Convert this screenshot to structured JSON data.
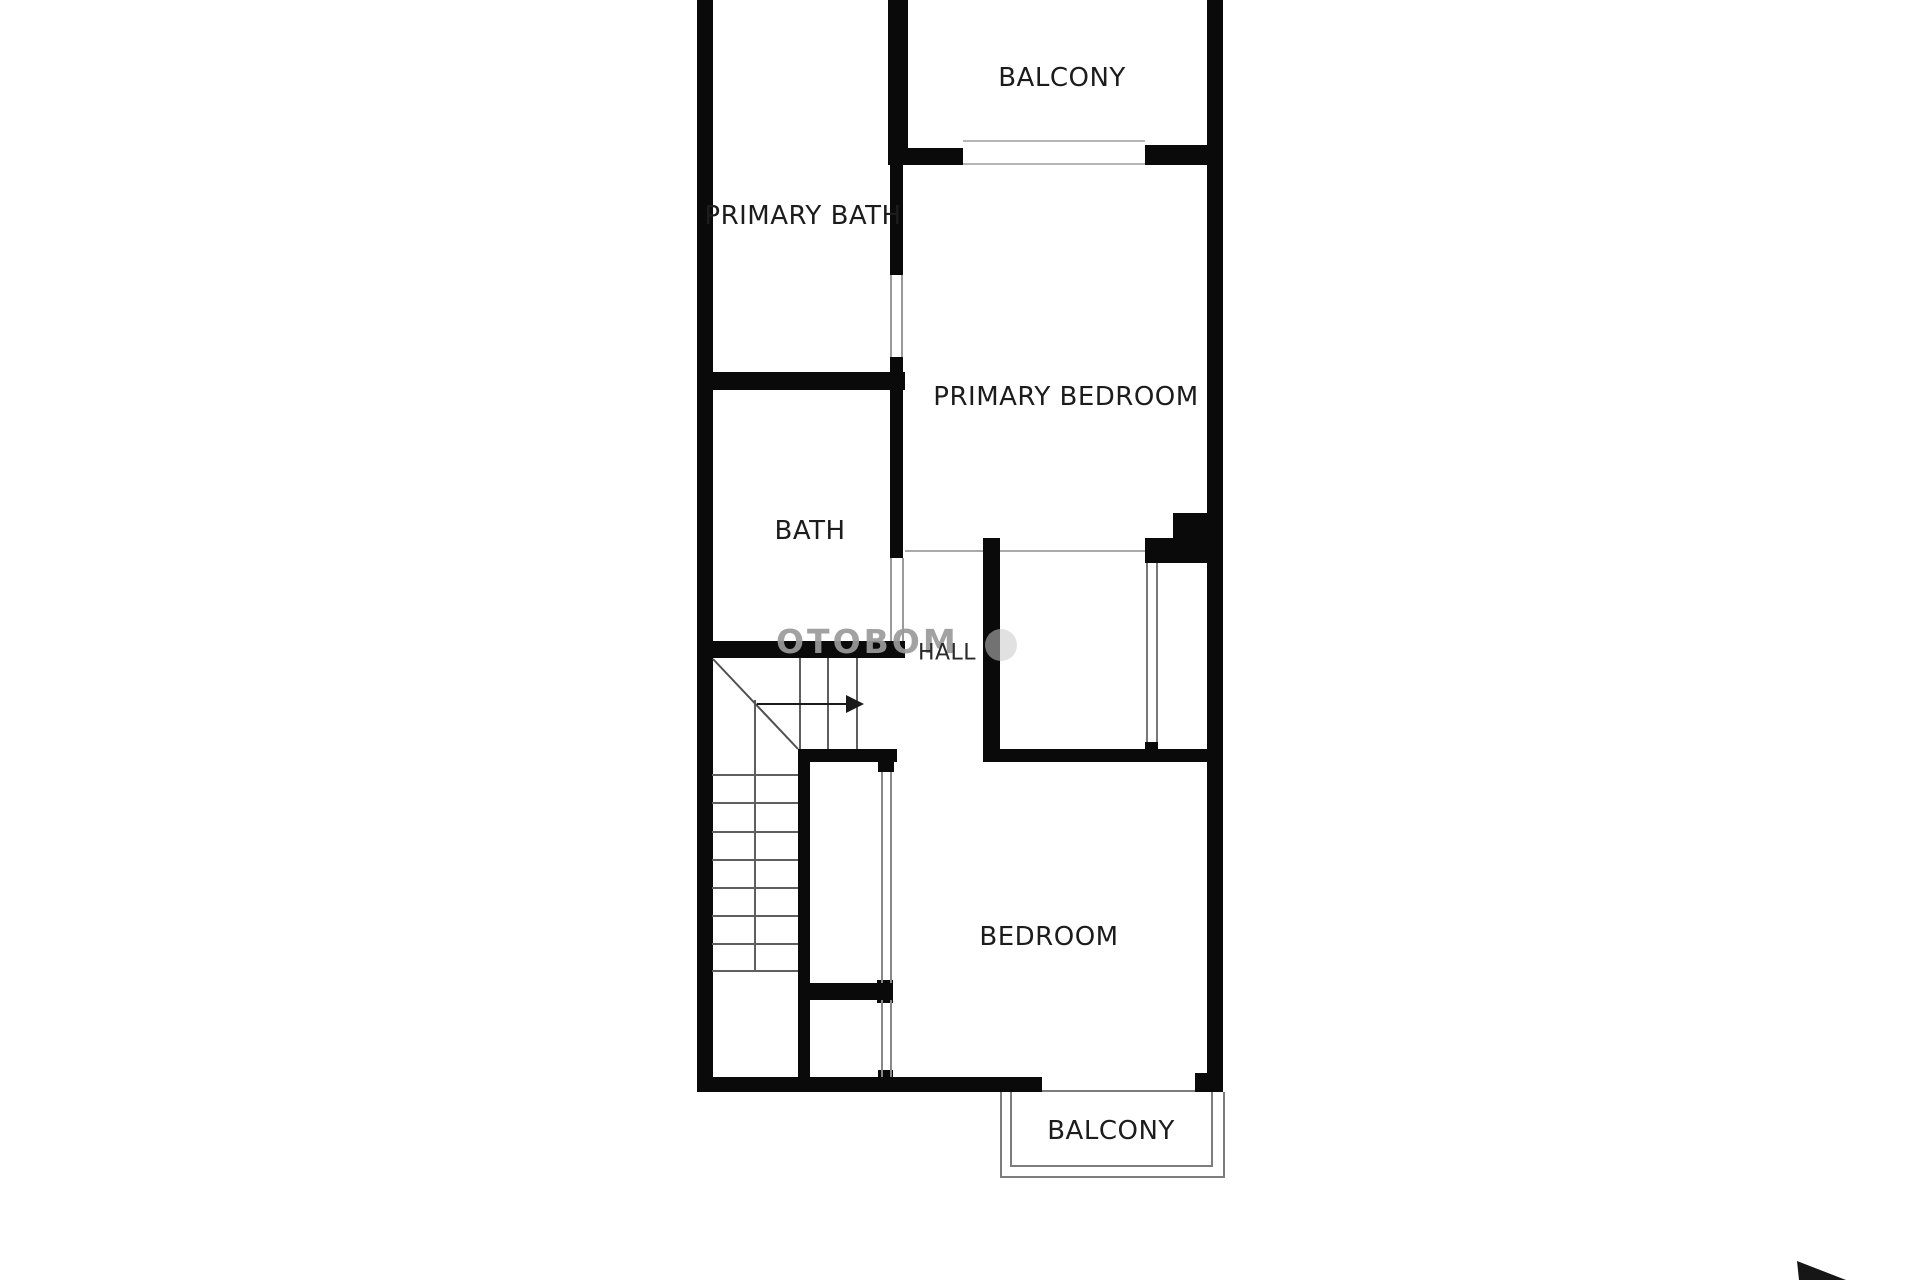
{
  "page": {
    "background": "#ffffff",
    "wall_color": "#0a0a0a",
    "label_color": "#1c1c1c",
    "thin_line_color": "#9a9a9a"
  },
  "labels": {
    "balcony_top": "BALCONY",
    "primary_bath": "PRIMARY BATH",
    "primary_bedroom": "PRIMARY BEDROOM",
    "bath": "BATH",
    "hall": "HALL",
    "bedroom": "BEDROOM",
    "balcony_bottom": "BALCONY"
  },
  "watermark": {
    "text": "OTOBOM"
  }
}
